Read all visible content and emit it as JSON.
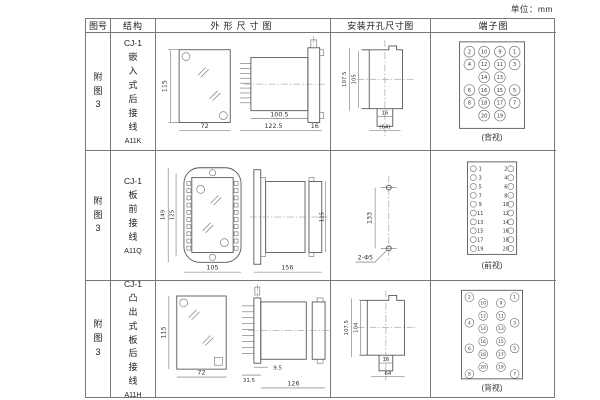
{
  "page": {
    "unit": "单位：mm"
  },
  "table": {
    "headers": {
      "fig": "图号",
      "structure": "结构",
      "outline": "外形尺寸图",
      "install": "安装开孔尺寸图",
      "terminal": "端子图"
    }
  },
  "rows": [
    {
      "fig": "附图3",
      "structure": {
        "model": "CJ-1",
        "type": "嵌入式后接线",
        "code": "A11K"
      },
      "outline": {
        "front_h": "115",
        "front_w": "72",
        "body_len": "100.5",
        "total_len": "122.5",
        "flange": "16"
      },
      "install": {
        "outer_h": "107.5",
        "inner_h": "105",
        "slot_w": "16",
        "span_w": "(64)"
      },
      "terminal": {
        "view": "(背视)",
        "grid": {
          "r1": [
            "2",
            "10",
            "9",
            "1"
          ],
          "r2": [
            "4",
            "12",
            "11",
            "3"
          ],
          "r3": [
            "14",
            "13"
          ],
          "r4": [
            "6",
            "16",
            "15",
            "5"
          ],
          "r5": [
            "8",
            "18",
            "17",
            "7"
          ],
          "r6": [
            "20",
            "19"
          ]
        }
      }
    },
    {
      "fig": "附图3",
      "structure": {
        "model": "CJ-1",
        "type": "板前接线",
        "code": "A11Q"
      },
      "outline": {
        "outer_h": "149",
        "inner_h": "125",
        "front_w": "105",
        "body_len": "156",
        "rear_h": "115"
      },
      "install": {
        "hole_span": "133",
        "hole_label": "2-Φ5"
      },
      "terminal": {
        "view": "(前视)",
        "left": [
          "1",
          "3",
          "5",
          "7",
          "9",
          "11",
          "13",
          "15",
          "17",
          "19"
        ],
        "right": [
          "2",
          "4",
          "6",
          "8",
          "10",
          "12",
          "14",
          "16",
          "18",
          "20"
        ]
      }
    },
    {
      "fig": "附图3",
      "structure": {
        "model": "CJ-1",
        "type": "凸出式板后接线",
        "code": "A11H"
      },
      "outline": {
        "front_h": "115",
        "front_w": "72",
        "pin_offset": "9.5",
        "pin_len": "31.5",
        "body_len": "126"
      },
      "install": {
        "outer_h": "107.5",
        "inner_h": "104",
        "slot_w": "16",
        "span_w": "64"
      },
      "terminal": {
        "view": "(背视)",
        "outer_left": [
          "2",
          "4",
          "6",
          "8"
        ],
        "inner_left": [
          "10",
          "12",
          "14",
          "16",
          "18",
          "20"
        ],
        "inner_right": [
          "9",
          "11",
          "13",
          "15",
          "17",
          "19"
        ],
        "outer_right": [
          "1",
          "3",
          "5",
          "7"
        ]
      }
    }
  ]
}
